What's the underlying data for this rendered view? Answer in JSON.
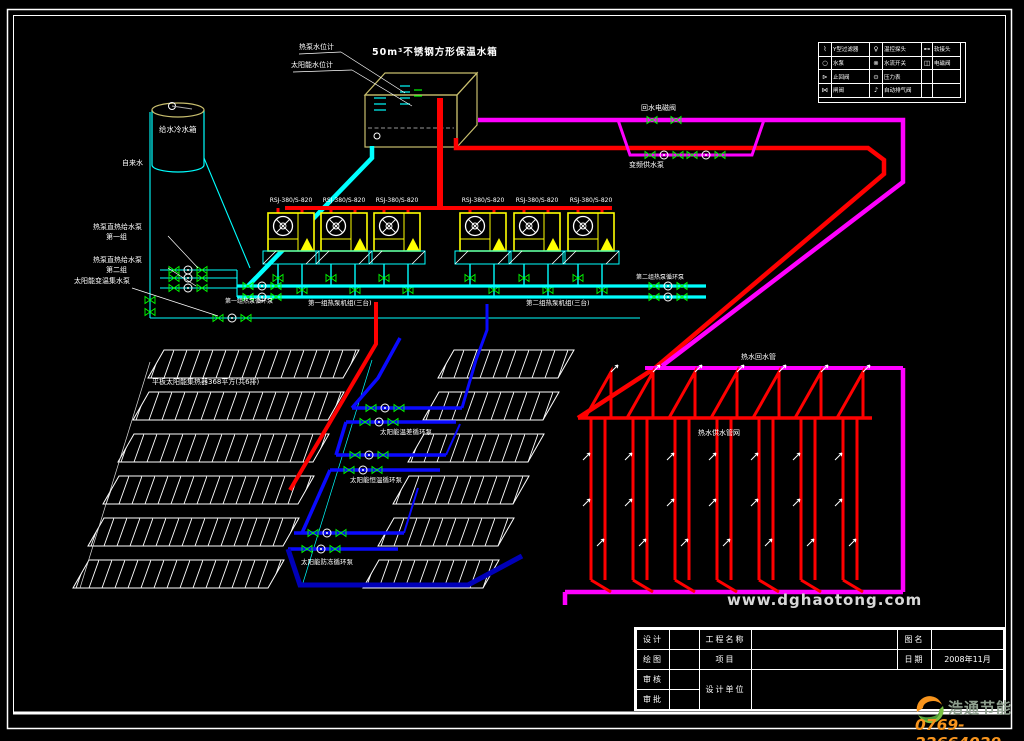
{
  "colors": {
    "pipe_hot": "#ff0000",
    "pipe_cold": "#00ffff",
    "pipe_return": "#ff00ff",
    "pipe_solar": "#0a0aff",
    "pipe_solar_dark": "#0000b8",
    "unit_frame": "#ffff00",
    "tank_frame": "#c8be6e",
    "brand_orange": "#f7941d",
    "brand_green": "#7ac143"
  },
  "tank": {
    "title": "50m³不锈钢方形保温水箱",
    "gauge_hp": "热泵水位计",
    "gauge_solar": "太阳能水位计"
  },
  "cold_tank": {
    "label": "给水冷水箱",
    "inlet": "自来水"
  },
  "feed_pumps": {
    "p1_l1": "热泵直热给水泵",
    "p1_l2": "第一组",
    "p2_l1": "热泵直热给水泵",
    "p2_l2": "第二组",
    "solar": "太阳能变温集水泵"
  },
  "heat_pumps": {
    "models": [
      "RSJ-380/S-820",
      "RSJ-380/S-820",
      "RSJ-380/S-820",
      "RSJ-380/S-820",
      "RSJ-380/S-820",
      "RSJ-380/S-820"
    ],
    "g1_units": "第一组热泵机组(三台)",
    "g1_pump": "第一组热泵循环泵",
    "g2_units": "第二组热泵机组(三台)",
    "g2_pump": "第二组热泵循环泵"
  },
  "supply_loop": {
    "solenoid_valve": "回水电磁阀",
    "vf_pump": "变频供水泵",
    "return_pipe": "热水回水管",
    "supply_network": "热水供水管网"
  },
  "collectors": {
    "area_label": "平板太阳能集热器368平方(共6排)",
    "pump_t": "太阳能温差循环泵",
    "pump_c": "太阳能恒温循环泵",
    "pump_f": "太阳能防冻循环泵"
  },
  "legend": {
    "rows": [
      {
        "s1": "⌇",
        "l1": "Y型过滤器",
        "s2": "♀",
        "l2": "温控探头",
        "s3": "⊷",
        "l3": "软接头"
      },
      {
        "s1": "○",
        "l1": "水泵",
        "s2": "⊗",
        "l2": "水流开关",
        "s3": "◫",
        "l3": "电磁阀"
      },
      {
        "s1": "⊳",
        "l1": "止回阀",
        "s2": "⊙",
        "l2": "压力表",
        "s3": "",
        "l3": ""
      },
      {
        "s1": "⋈",
        "l1": "闸阀",
        "s2": "♪",
        "l2": "自动排气阀",
        "s3": "",
        "l3": ""
      }
    ]
  },
  "titleblock": {
    "design": "设计",
    "draw": "绘图",
    "check": "审核",
    "approve": "审批",
    "project_name": "工程名称",
    "project": "项目",
    "design_unit": "设计单位",
    "drawing_name": "图名",
    "date_label": "日期",
    "date_value": "2008年11月"
  },
  "watermark": "www.dghaotong.com",
  "logo": {
    "brand": "浩通节能",
    "phone": "0769-22664029"
  }
}
